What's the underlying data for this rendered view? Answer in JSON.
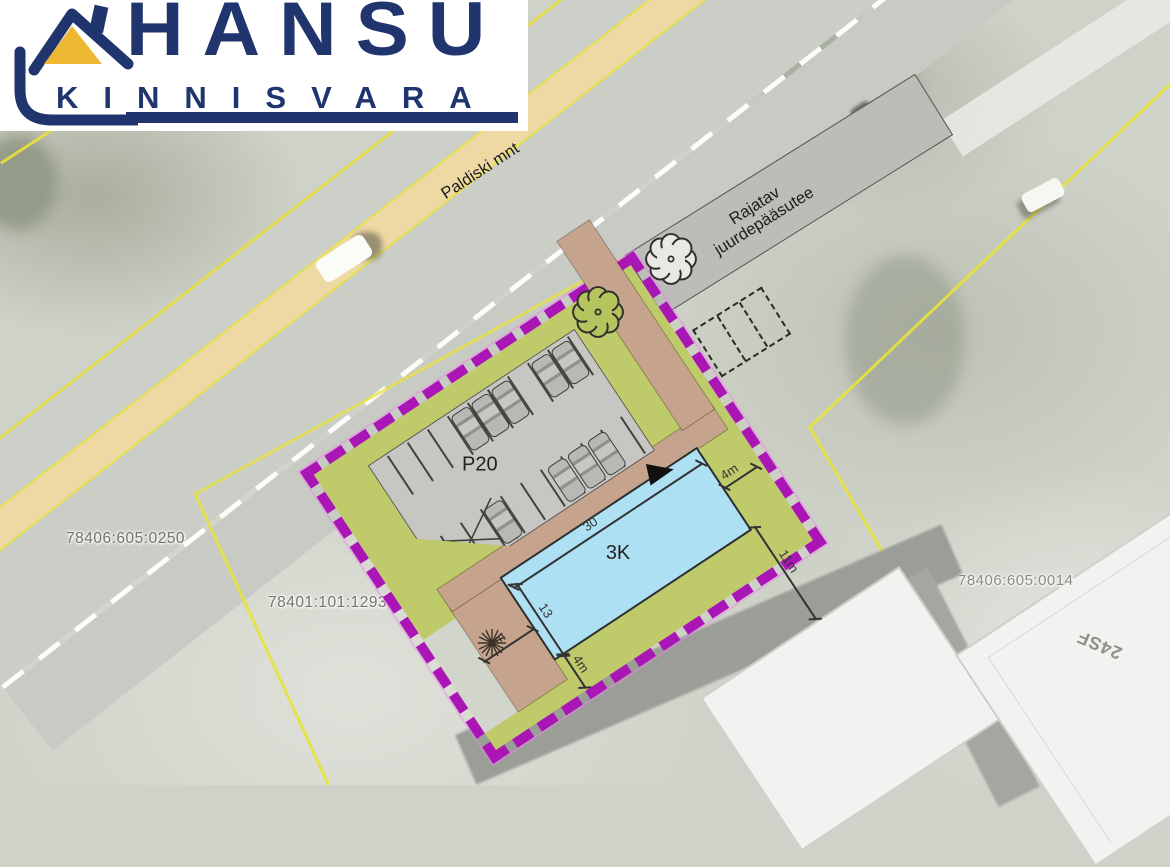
{
  "logo": {
    "title": "HANSU",
    "subtitle": "KINNISVARA"
  },
  "aerial": {
    "road_label": "Paldiski mnt",
    "parcel_left": "78406:605:0250",
    "parcel_center": "78401:101:1293",
    "parcel_right": "78406:605:0014",
    "building_corner_label": "24SF"
  },
  "plan": {
    "access_road_line1": "Rajatav",
    "access_road_line2": "juurdepääsutee",
    "parking_label": "P20",
    "building_label": "3K",
    "dim_length": "30",
    "dim_width": "13",
    "dim_ne": "4m",
    "dim_se": "11m",
    "dim_sw": "4m",
    "dim_s": "4m"
  },
  "colors": {
    "boundary_purple": "#a916b5",
    "landscape_green": "#bfca6b",
    "path_tan": "#c6a38c",
    "parking_gray": "#c6c6c3",
    "building_blue": "#aee0f3",
    "access_gray": "#bcbdb8",
    "logo_navy": "#20356e",
    "roof_yellow": "#efb832",
    "accessible_blue": "#79a7e8"
  }
}
